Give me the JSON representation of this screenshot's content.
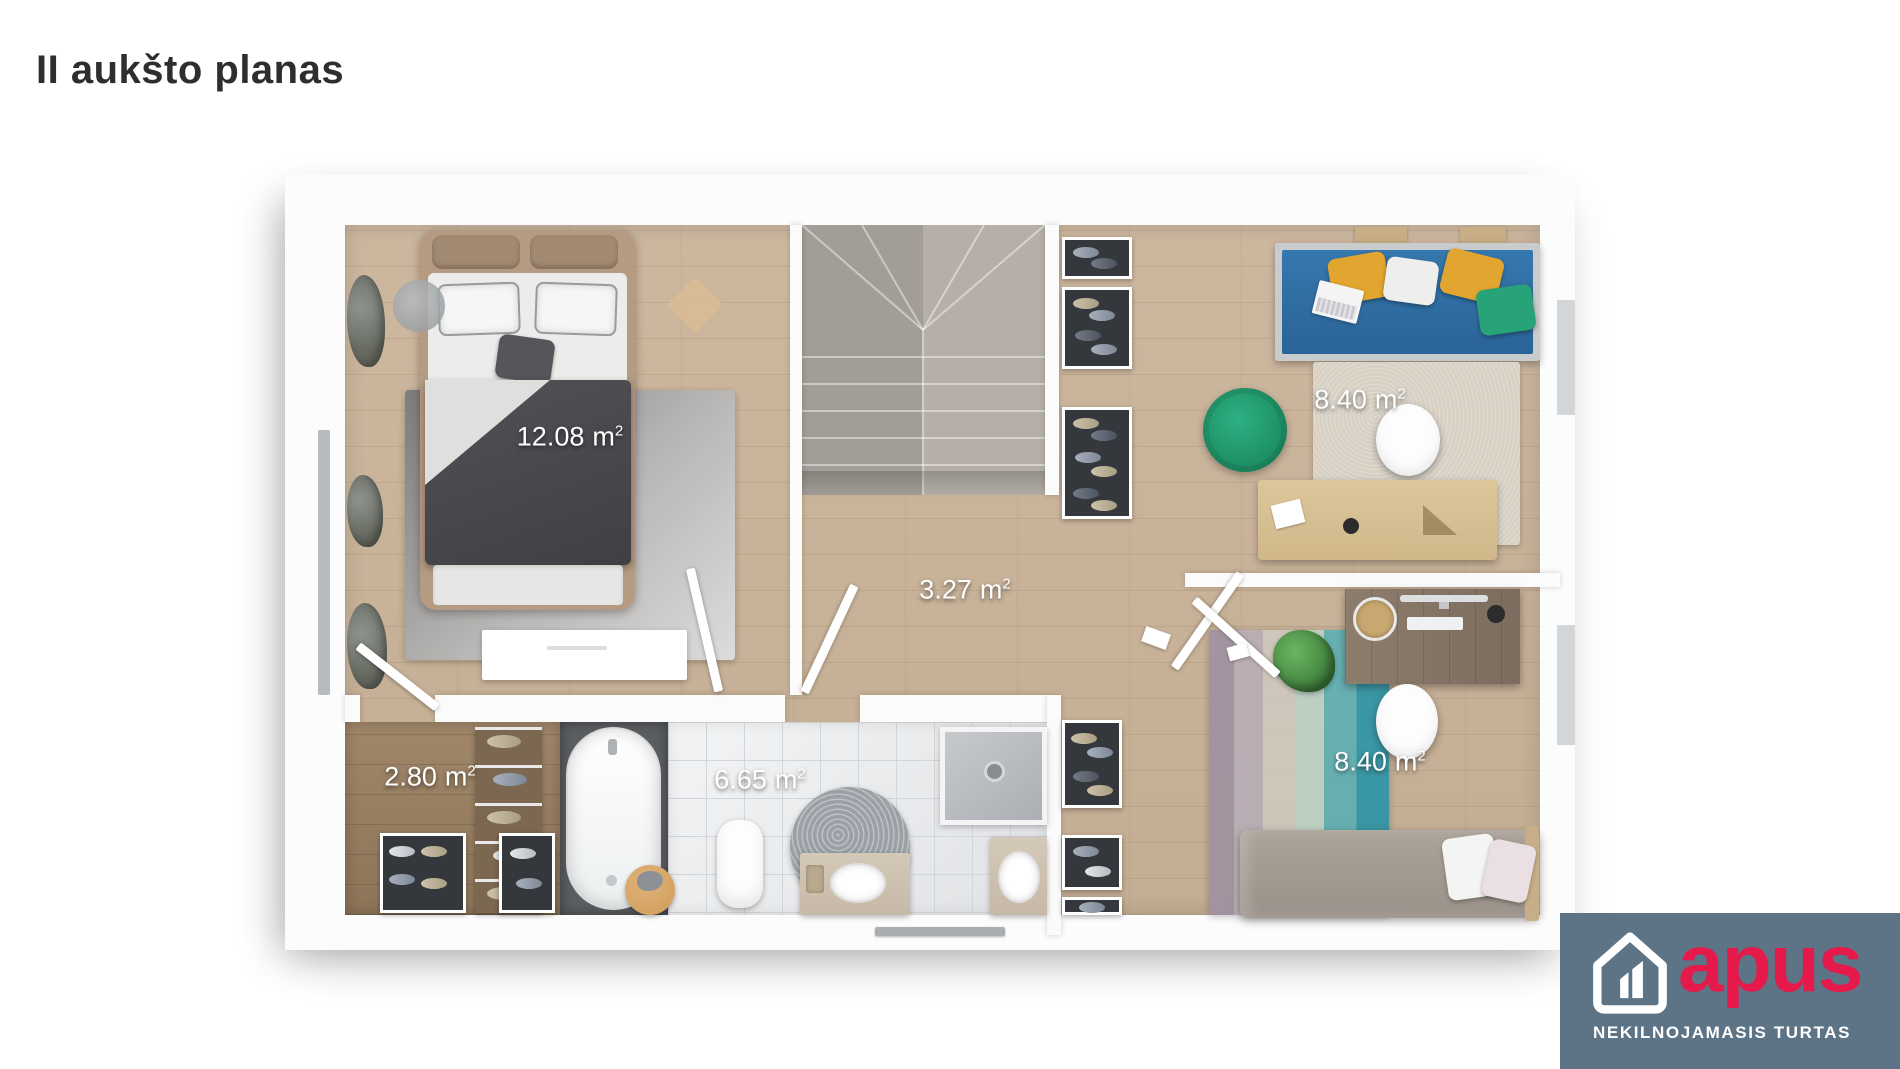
{
  "page": {
    "title": "II aukšto planas"
  },
  "floorplan": {
    "labels": [
      {
        "room": "bedroom-1",
        "value": "12.08",
        "unit": "m",
        "sup": "2"
      },
      {
        "room": "office-room",
        "value": "8.40",
        "unit": "m",
        "sup": "2"
      },
      {
        "room": "hallway",
        "value": "3.27",
        "unit": "m",
        "sup": "2"
      },
      {
        "room": "wardrobe",
        "value": "2.80",
        "unit": "m",
        "sup": "2"
      },
      {
        "room": "bathroom",
        "value": "6.65",
        "unit": "m",
        "sup": "2"
      },
      {
        "room": "bedroom-2",
        "value": "8.40",
        "unit": "m",
        "sup": "2"
      }
    ]
  },
  "logo": {
    "brand": "apus",
    "tagline": "NEKILNOJAMASIS TURTAS",
    "accent": "#e6194b",
    "background": "#5d7386"
  }
}
